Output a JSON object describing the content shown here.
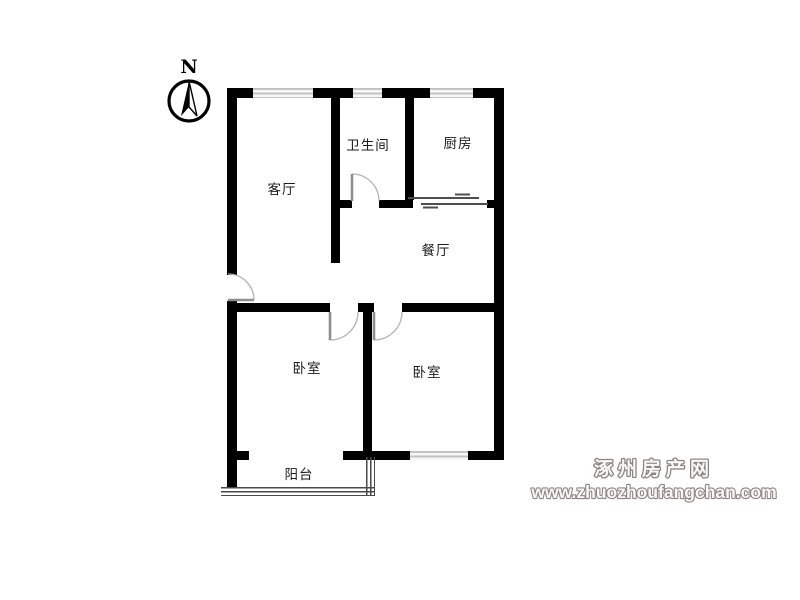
{
  "compass": {
    "north_label": "N"
  },
  "rooms": {
    "living": {
      "label": "客厅"
    },
    "bathroom": {
      "label": "卫生间"
    },
    "kitchen": {
      "label": "厨房"
    },
    "dining": {
      "label": "餐厅"
    },
    "bedroom_left": {
      "label": "卧室"
    },
    "bedroom_right": {
      "label": "卧室"
    },
    "balcony": {
      "label": "阳台"
    }
  },
  "watermark": {
    "site_name": "涿州房产网",
    "site_url": "www.zhuozhoufangchan.com",
    "color": "#8d8583"
  },
  "colors": {
    "wall": "#000000",
    "window_stripe": "#c3c3c3",
    "door_arc": "#b3b3b3",
    "background": "#ffffff"
  }
}
